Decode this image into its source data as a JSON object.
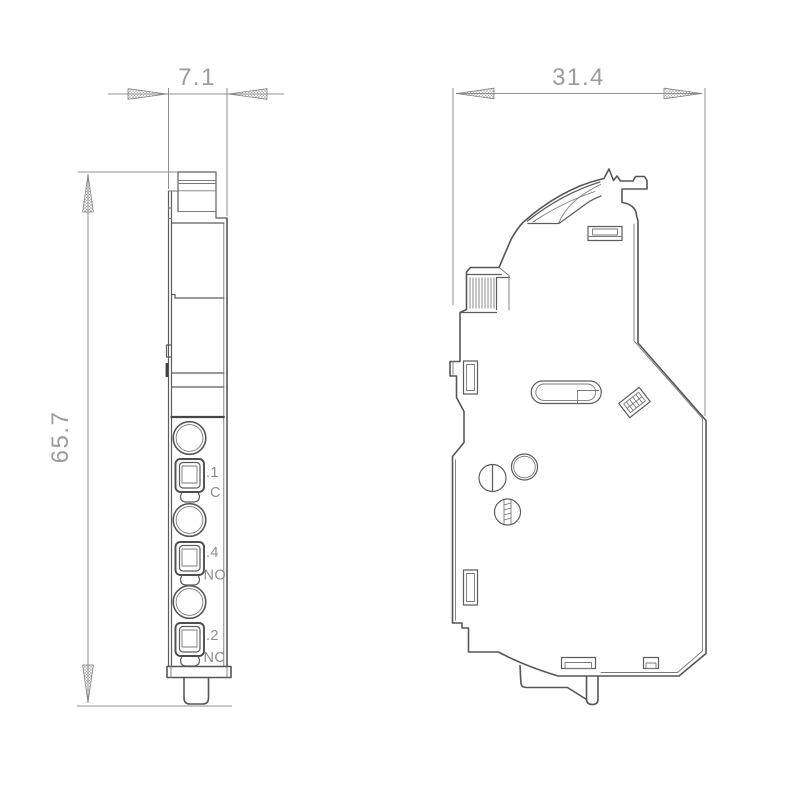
{
  "drawing": {
    "background": "#ffffff",
    "line_color": "#565656",
    "dim_line_color": "#909090",
    "dim_text_color": "#9c9c9c",
    "label_text_color": "#8c8c8c",
    "dimensions": {
      "front_width": "7.1",
      "side_width": "31.4",
      "height": "65.7"
    },
    "front_view": {
      "terminals": [
        {
          "number": ".1",
          "code": "C"
        },
        {
          "number": ".4",
          "code": "NO"
        },
        {
          "number": ".2",
          "code": "NC"
        }
      ]
    }
  }
}
